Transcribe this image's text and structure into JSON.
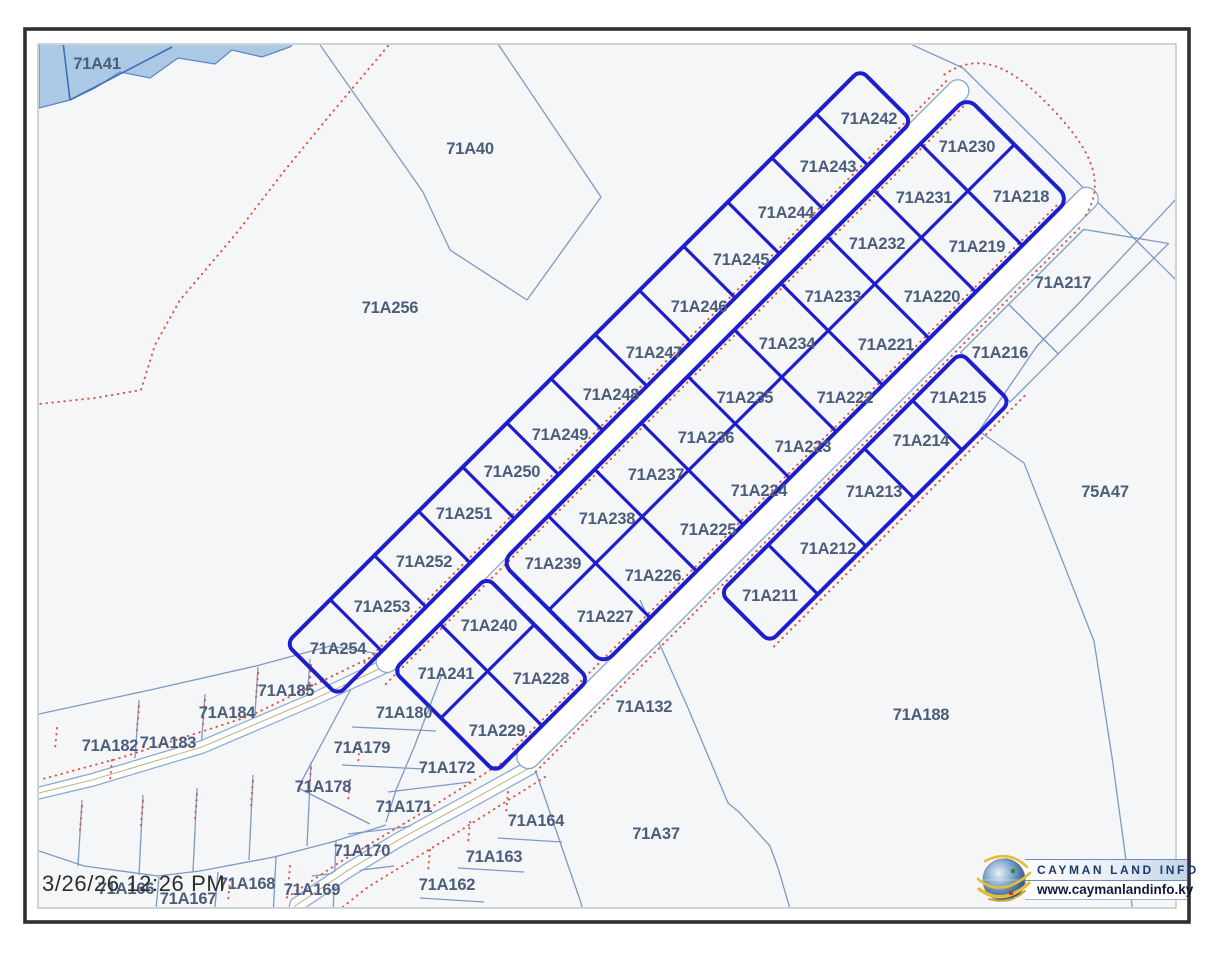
{
  "frame": {
    "timestamp": "3/26/26 12:26 PM"
  },
  "logo": {
    "title": "CAYMAN LAND INFO",
    "website": "www.caymanlandinfo.ky"
  },
  "colors": {
    "bold_parcel_outline": "#1e1ecb",
    "background_parcel_line": "#7d99c7",
    "label_text": "#4c5d7c",
    "boundary_dotted": "#e0564a",
    "water_fill": "#abc8e5",
    "road_fill": "#ffffff"
  },
  "subdivision": {
    "northwest_strip": [
      "71A254",
      "71A253",
      "71A252",
      "71A251",
      "71A250",
      "71A249",
      "71A248",
      "71A247",
      "71A246",
      "71A245",
      "71A244",
      "71A243",
      "71A242"
    ],
    "middle_strip_northwest_column": [
      "71A239",
      "71A238",
      "71A237",
      "71A236",
      "71A235",
      "71A234",
      "71A233",
      "71A232",
      "71A231",
      "71A230"
    ],
    "middle_strip_southeast_column": [
      "71A227",
      "71A226",
      "71A225",
      "71A224",
      "71A223",
      "71A222",
      "71A221",
      "71A220",
      "71A219",
      "71A218"
    ],
    "southeast_strip": [
      "71A211",
      "71A212",
      "71A213",
      "71A214",
      "71A215"
    ],
    "southwest_block": [
      "71A241",
      "71A240",
      "71A229",
      "71A228"
    ]
  },
  "background_parcels": [
    "71A41",
    "71A40",
    "71A256",
    "75A47",
    "71A217",
    "71A216",
    "71A132",
    "71A188",
    "71A37",
    "71A185",
    "71A184",
    "71A183",
    "71A182",
    "71A180",
    "71A179",
    "71A178",
    "71A172",
    "71A171",
    "71A170",
    "71A164",
    "71A163",
    "71A162",
    "71A166",
    "71A167",
    "71A168",
    "71A169"
  ],
  "labels": [
    {
      "text": "71A41",
      "x": 97,
      "y": 63,
      "kind": "background"
    },
    {
      "text": "71A40",
      "x": 470,
      "y": 148,
      "kind": "background"
    },
    {
      "text": "71A256",
      "x": 390,
      "y": 307,
      "kind": "background"
    },
    {
      "text": "75A47",
      "x": 1105,
      "y": 491,
      "kind": "background"
    },
    {
      "text": "71A217",
      "x": 1063,
      "y": 282,
      "kind": "background"
    },
    {
      "text": "71A216",
      "x": 1000,
      "y": 352,
      "kind": "background"
    },
    {
      "text": "71A132",
      "x": 644,
      "y": 706,
      "kind": "background"
    },
    {
      "text": "71A188",
      "x": 921,
      "y": 714,
      "kind": "background"
    },
    {
      "text": "71A37",
      "x": 656,
      "y": 833,
      "kind": "background"
    },
    {
      "text": "71A185",
      "x": 286,
      "y": 690,
      "kind": "background"
    },
    {
      "text": "71A184",
      "x": 227,
      "y": 712,
      "kind": "background"
    },
    {
      "text": "71A183",
      "x": 168,
      "y": 742,
      "kind": "background"
    },
    {
      "text": "71A182",
      "x": 110,
      "y": 745,
      "kind": "background"
    },
    {
      "text": "71A180",
      "x": 404,
      "y": 712,
      "kind": "background"
    },
    {
      "text": "71A179",
      "x": 362,
      "y": 747,
      "kind": "background"
    },
    {
      "text": "71A178",
      "x": 323,
      "y": 786,
      "kind": "background"
    },
    {
      "text": "71A172",
      "x": 447,
      "y": 767,
      "kind": "background"
    },
    {
      "text": "71A171",
      "x": 404,
      "y": 806,
      "kind": "background"
    },
    {
      "text": "71A170",
      "x": 362,
      "y": 850,
      "kind": "background"
    },
    {
      "text": "71A164",
      "x": 536,
      "y": 820,
      "kind": "background"
    },
    {
      "text": "71A163",
      "x": 494,
      "y": 856,
      "kind": "background"
    },
    {
      "text": "71A162",
      "x": 447,
      "y": 884,
      "kind": "background"
    },
    {
      "text": "71A166",
      "x": 126,
      "y": 888,
      "kind": "background"
    },
    {
      "text": "71A167",
      "x": 188,
      "y": 898,
      "kind": "background"
    },
    {
      "text": "71A168",
      "x": 247,
      "y": 883,
      "kind": "background"
    },
    {
      "text": "71A169",
      "x": 312,
      "y": 889,
      "kind": "background"
    },
    {
      "text": "71A242",
      "x": 869,
      "y": 118,
      "kind": "subdivision"
    },
    {
      "text": "71A243",
      "x": 828,
      "y": 166,
      "kind": "subdivision"
    },
    {
      "text": "71A244",
      "x": 786,
      "y": 212,
      "kind": "subdivision"
    },
    {
      "text": "71A245",
      "x": 741,
      "y": 259,
      "kind": "subdivision"
    },
    {
      "text": "71A246",
      "x": 699,
      "y": 306,
      "kind": "subdivision"
    },
    {
      "text": "71A247",
      "x": 654,
      "y": 352,
      "kind": "subdivision"
    },
    {
      "text": "71A248",
      "x": 611,
      "y": 394,
      "kind": "subdivision"
    },
    {
      "text": "71A249",
      "x": 560,
      "y": 434,
      "kind": "subdivision"
    },
    {
      "text": "71A250",
      "x": 512,
      "y": 471,
      "kind": "subdivision"
    },
    {
      "text": "71A251",
      "x": 464,
      "y": 513,
      "kind": "subdivision"
    },
    {
      "text": "71A252",
      "x": 424,
      "y": 561,
      "kind": "subdivision"
    },
    {
      "text": "71A253",
      "x": 382,
      "y": 606,
      "kind": "subdivision"
    },
    {
      "text": "71A254",
      "x": 338,
      "y": 648,
      "kind": "subdivision"
    },
    {
      "text": "71A230",
      "x": 967,
      "y": 146,
      "kind": "subdivision"
    },
    {
      "text": "71A231",
      "x": 924,
      "y": 197,
      "kind": "subdivision"
    },
    {
      "text": "71A232",
      "x": 877,
      "y": 243,
      "kind": "subdivision"
    },
    {
      "text": "71A233",
      "x": 833,
      "y": 296,
      "kind": "subdivision"
    },
    {
      "text": "71A234",
      "x": 787,
      "y": 343,
      "kind": "subdivision"
    },
    {
      "text": "71A235",
      "x": 745,
      "y": 397,
      "kind": "subdivision"
    },
    {
      "text": "71A236",
      "x": 706,
      "y": 437,
      "kind": "subdivision"
    },
    {
      "text": "71A237",
      "x": 656,
      "y": 474,
      "kind": "subdivision"
    },
    {
      "text": "71A238",
      "x": 607,
      "y": 518,
      "kind": "subdivision"
    },
    {
      "text": "71A239",
      "x": 553,
      "y": 563,
      "kind": "subdivision"
    },
    {
      "text": "71A218",
      "x": 1021,
      "y": 196,
      "kind": "subdivision"
    },
    {
      "text": "71A219",
      "x": 977,
      "y": 246,
      "kind": "subdivision"
    },
    {
      "text": "71A220",
      "x": 932,
      "y": 296,
      "kind": "subdivision"
    },
    {
      "text": "71A221",
      "x": 886,
      "y": 344,
      "kind": "subdivision"
    },
    {
      "text": "71A222",
      "x": 845,
      "y": 397,
      "kind": "subdivision"
    },
    {
      "text": "71A223",
      "x": 803,
      "y": 446,
      "kind": "subdivision"
    },
    {
      "text": "71A224",
      "x": 759,
      "y": 490,
      "kind": "subdivision"
    },
    {
      "text": "71A225",
      "x": 708,
      "y": 529,
      "kind": "subdivision"
    },
    {
      "text": "71A226",
      "x": 653,
      "y": 575,
      "kind": "subdivision"
    },
    {
      "text": "71A227",
      "x": 605,
      "y": 616,
      "kind": "subdivision"
    },
    {
      "text": "71A215",
      "x": 958,
      "y": 397,
      "kind": "subdivision"
    },
    {
      "text": "71A214",
      "x": 921,
      "y": 440,
      "kind": "subdivision"
    },
    {
      "text": "71A213",
      "x": 874,
      "y": 491,
      "kind": "subdivision"
    },
    {
      "text": "71A212",
      "x": 828,
      "y": 548,
      "kind": "subdivision"
    },
    {
      "text": "71A211",
      "x": 770,
      "y": 595,
      "kind": "subdivision"
    },
    {
      "text": "71A240",
      "x": 489,
      "y": 625,
      "kind": "subdivision"
    },
    {
      "text": "71A241",
      "x": 446,
      "y": 673,
      "kind": "subdivision"
    },
    {
      "text": "71A228",
      "x": 541,
      "y": 678,
      "kind": "subdivision"
    },
    {
      "text": "71A229",
      "x": 497,
      "y": 730,
      "kind": "subdivision"
    }
  ]
}
